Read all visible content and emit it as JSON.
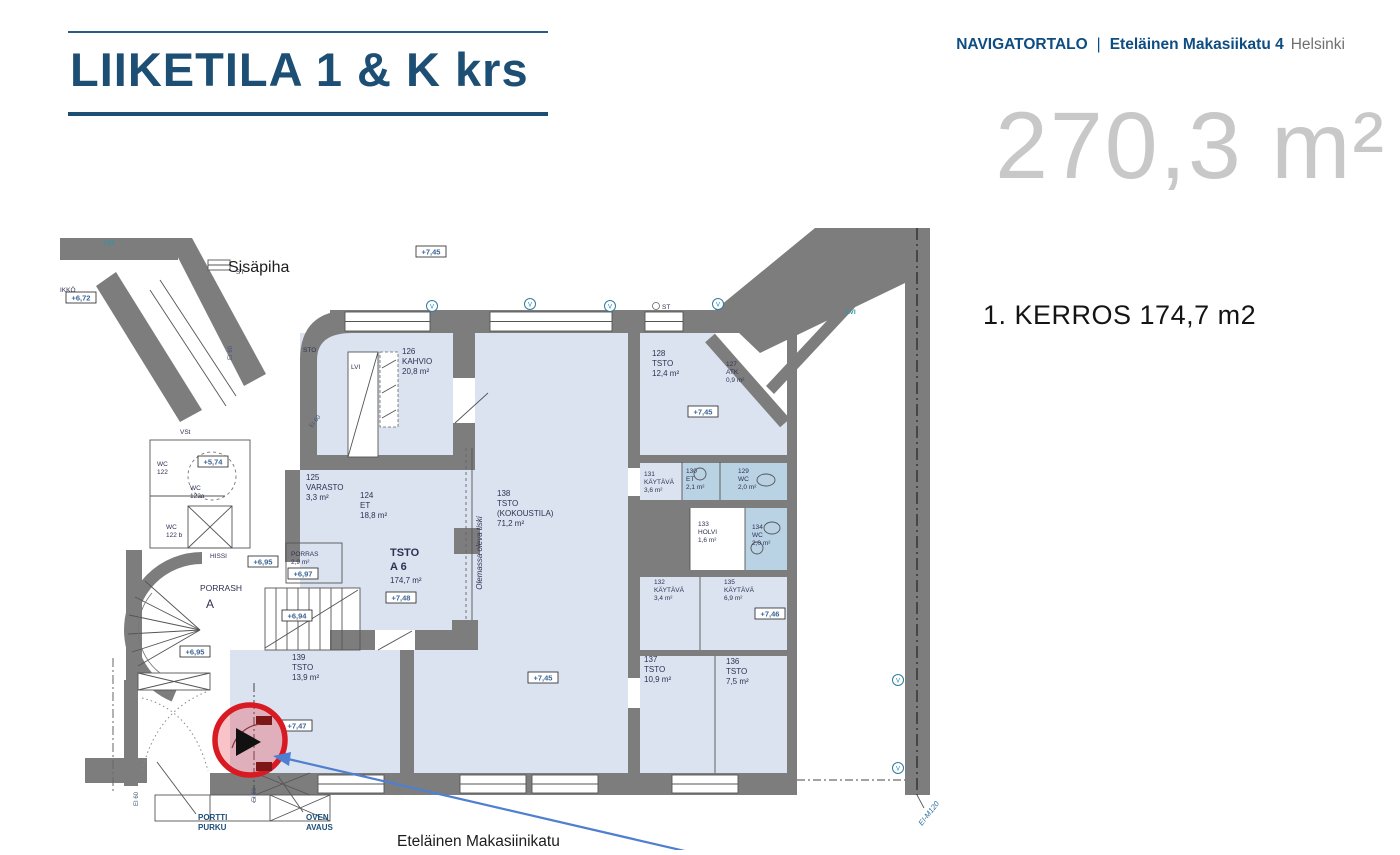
{
  "header": {
    "title": "LIIKETILA 1 & K krs",
    "building": "NAVIGATORTALO",
    "separator": "|",
    "address": "Eteläinen Makasiikatu 4",
    "city": "Helsinki",
    "total_area": "270,3 m²",
    "floor_heading": "1. KERROS 174,7 m2"
  },
  "plan": {
    "courtyard_label": "Sisäpiha",
    "street_label": "Eteläinen Makasiinikatu",
    "rooms": [
      {
        "n": "126",
        "l1": "KAHVIO",
        "a": "20,8 m²"
      },
      {
        "n": "128",
        "l1": "TSTO",
        "a": "12,4 m²"
      },
      {
        "n": "127",
        "l1": "ATK",
        "a": "0,9 m²"
      },
      {
        "n": "125",
        "l1": "VARASTO",
        "a": "3,3 m²"
      },
      {
        "n": "124",
        "l1": "ET",
        "a": "18,8 m²"
      },
      {
        "n": "138",
        "l1": "TSTO",
        "l2": "(KOKOUSTILA)",
        "a": "71,2 m²"
      },
      {
        "n": "131",
        "l1": "KÄYTÄVÄ",
        "a": "3,6 m²"
      },
      {
        "n": "130",
        "l1": "ET",
        "a": "2,1 m²"
      },
      {
        "n": "129",
        "l1": "WC",
        "a": "2,0 m²"
      },
      {
        "n": "133",
        "l1": "HOLVI",
        "a": "1,6 m²"
      },
      {
        "n": "134",
        "l1": "WC",
        "a": "2,0 m²"
      },
      {
        "n": "132",
        "l1": "KÄYTÄVÄ",
        "a": "3,4 m²"
      },
      {
        "n": "135",
        "l1": "KÄYTÄVÄ",
        "a": "6,9 m²"
      },
      {
        "n": "137",
        "l1": "TSTO",
        "a": "10,9 m²"
      },
      {
        "n": "136",
        "l1": "TSTO",
        "a": "7,5 m²"
      },
      {
        "n": "139",
        "l1": "TSTO",
        "a": "13,9 m²"
      },
      {
        "l1": "PORRAS",
        "a": "2,9 m²"
      },
      {
        "l1": "TSTO",
        "l2": "A 6",
        "a": "174,7 m²"
      }
    ],
    "labels": {
      "porrash": "PORRASH",
      "porrash_letter": "A",
      "hissi": "HISSI",
      "wc": "WC",
      "wc122": "122",
      "wc122a": "122a",
      "wc122b": "122 b",
      "vst": "VSt",
      "sto": "STO",
      "lvi": "LVI",
      "st": "ST",
      "ikko": "IKKÖ",
      "tiski": "Olemassa oleva tiski",
      "v": "V",
      "portti1": "PORTTI",
      "portti2": "PURKU",
      "oven1": "OVEN",
      "oven2": "AVAUS",
      "ei60": "EI 60",
      "eim120": "EI-M120"
    },
    "levels": {
      "l572": "+6,72",
      "l574": "+5,74",
      "l694": "+6,94",
      "l695": "+6,95",
      "l697": "+6,97",
      "l745": "+7,45",
      "l746": "+7,46",
      "l747": "+7,47",
      "l748": "+7,48"
    }
  },
  "colors": {
    "accent_blue": "#1d4e74",
    "wall_gray": "#7d7d7d",
    "room_fill": "#dbe3f0",
    "wet_fill": "#b9d2e4",
    "highlight_red": "#d81a22",
    "arrow_blue": "#4e7fd0",
    "big_area_gray": "#c8c8c8"
  }
}
